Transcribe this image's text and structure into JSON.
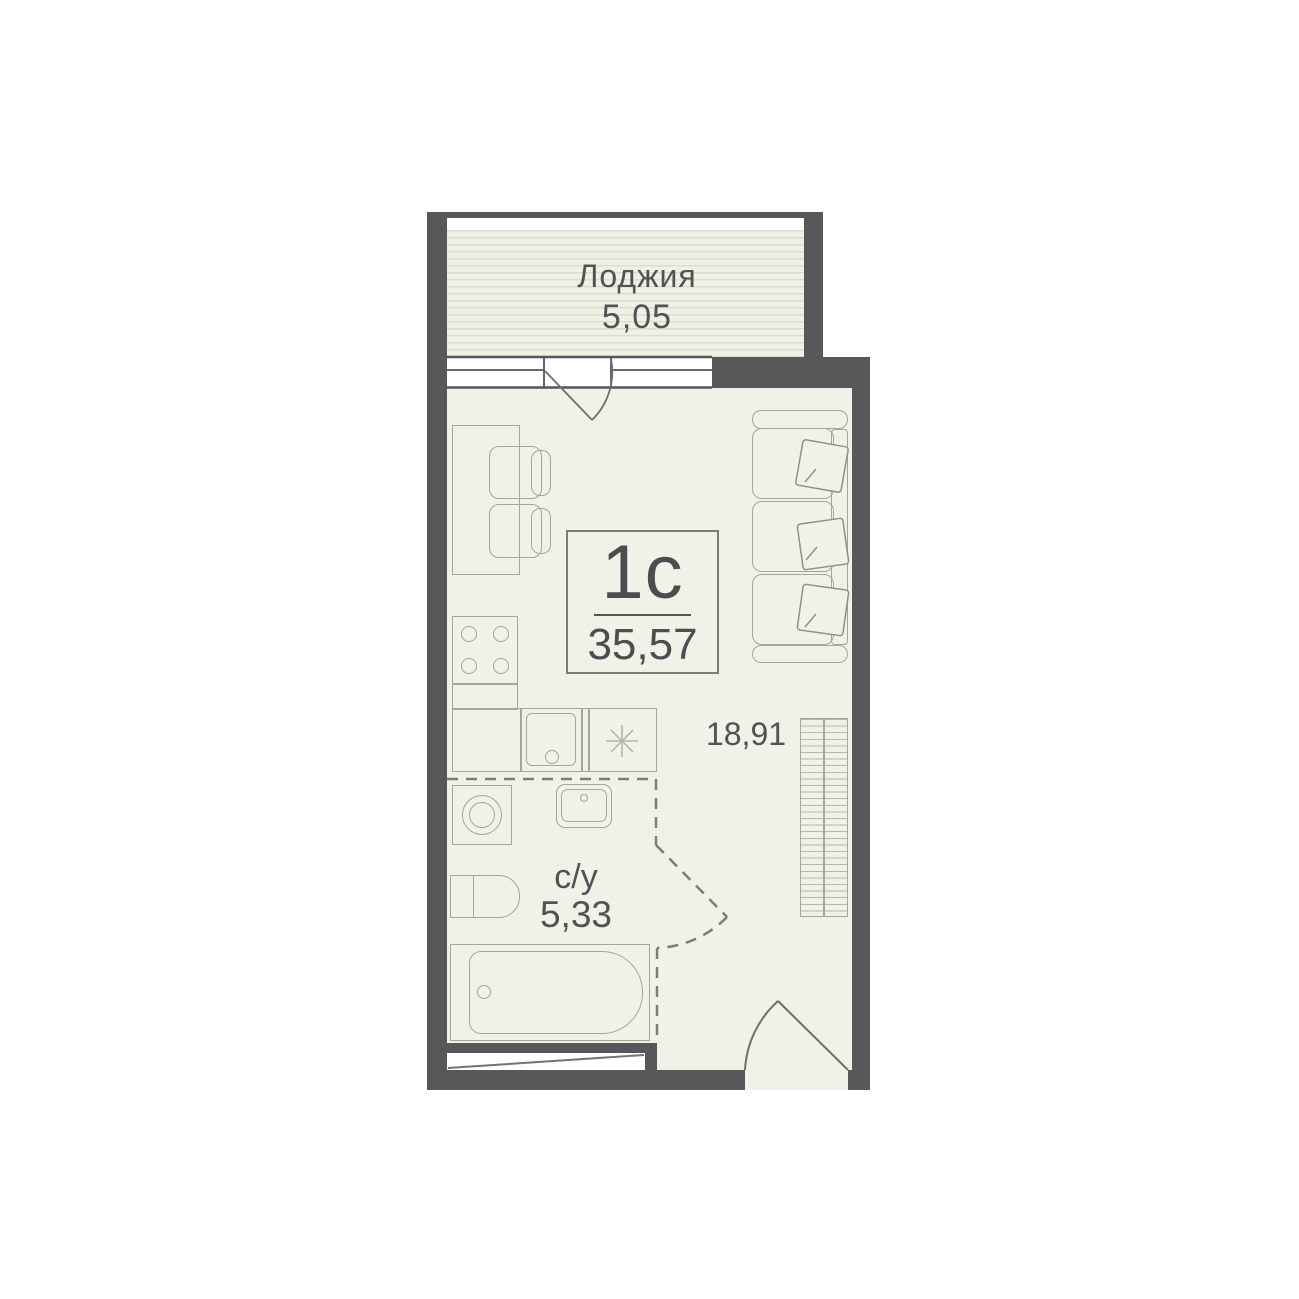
{
  "plan": {
    "loggia": {
      "label": "Лоджия",
      "area": "5,05"
    },
    "unit": {
      "type": "1с",
      "total_area": "35,57"
    },
    "living_room": {
      "area": "18,91"
    },
    "bathroom": {
      "label": "с/у",
      "area": "5,33"
    }
  },
  "colors": {
    "wall": "#58585A",
    "floor": "#F1F1E8",
    "loggia_floor": "#F0F0E5",
    "furniture_outline": "#A5A59A",
    "dashed_partition": "#7D7D76",
    "text": "#515156",
    "window": "#FFFFFF"
  },
  "furniture_icons": [
    "dining-table",
    "chair",
    "stove",
    "kitchen-sink",
    "refrigerator",
    "washing-machine",
    "bathroom-sink",
    "toilet",
    "bathtub",
    "wardrobe",
    "sofa",
    "pillow"
  ]
}
